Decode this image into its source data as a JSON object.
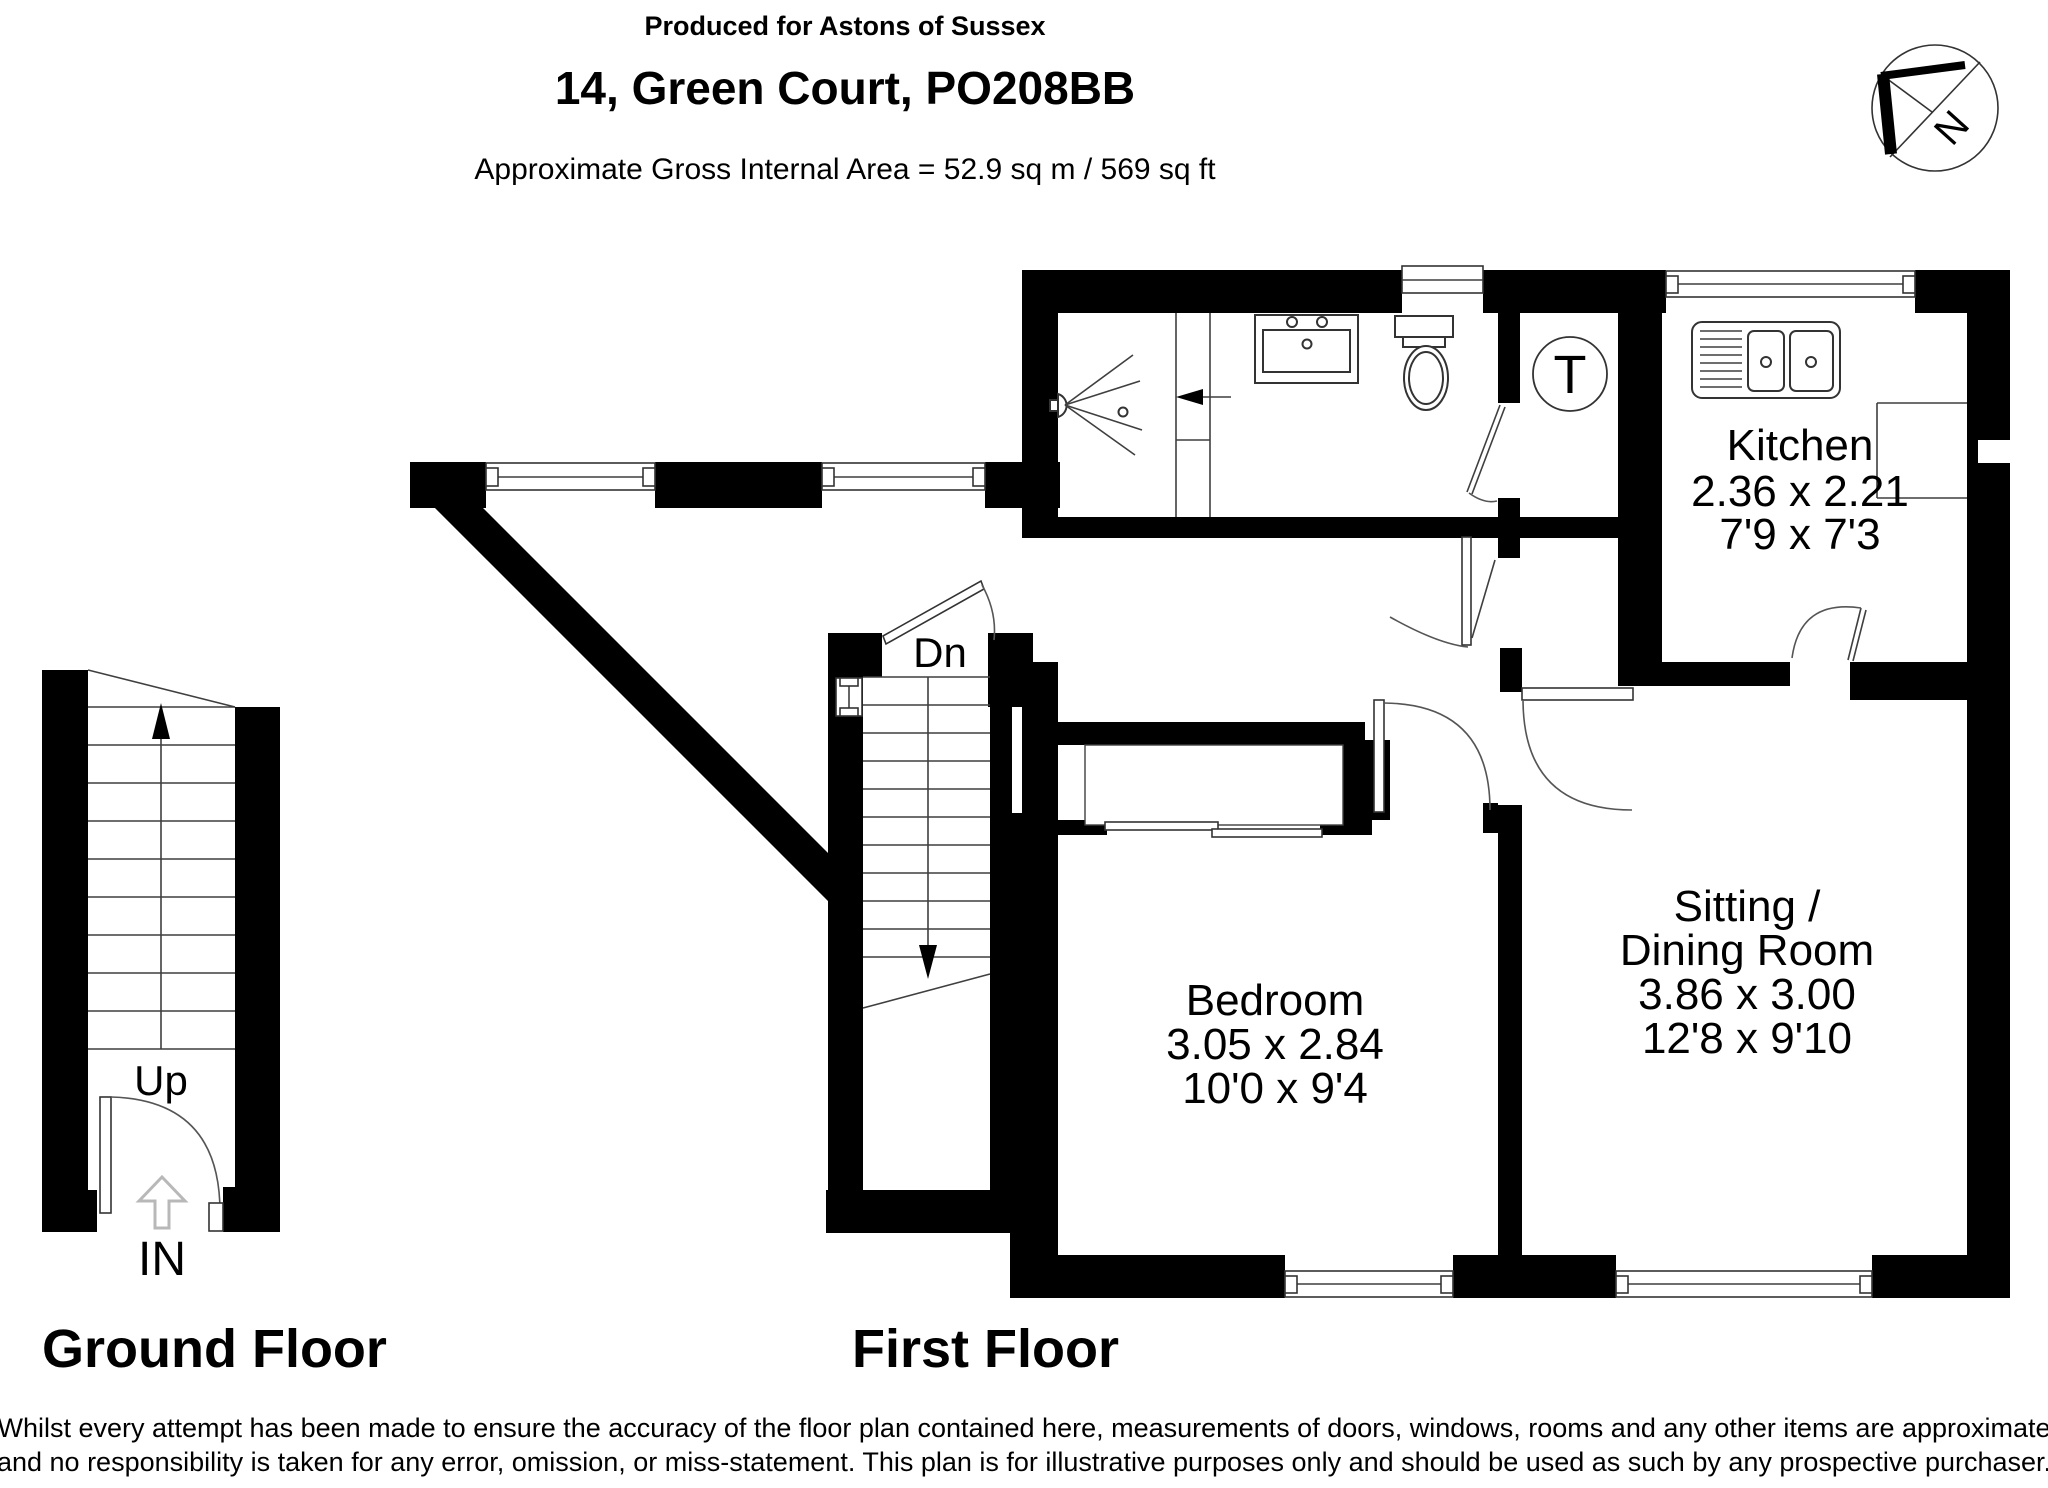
{
  "header": {
    "produced_for": "Produced for Astons of Sussex",
    "address": "14, Green Court, PO208BB",
    "area_line": "Approximate Gross Internal Area = 52.9 sq m / 569 sq ft"
  },
  "compass": {
    "north_label": "N"
  },
  "floors": {
    "ground": {
      "label": "Ground Floor",
      "up_label": "Up",
      "in_label": "IN"
    },
    "first": {
      "label": "First Floor",
      "down_label": "Dn",
      "tank_label": "T"
    }
  },
  "rooms": {
    "kitchen": {
      "name": "Kitchen",
      "metric": "2.36 x 2.21",
      "imperial": "7'9 x 7'3"
    },
    "bedroom": {
      "name": "Bedroom",
      "metric": "3.05 x 2.84",
      "imperial": "10'0 x 9'4"
    },
    "sitting": {
      "name_line1": "Sitting /",
      "name_line2": "Dining Room",
      "metric": "3.86 x 3.00",
      "imperial": "12'8 x 9'10"
    }
  },
  "disclaimer": {
    "line1": "Whilst every attempt has been made to ensure the accuracy of the floor plan contained here, measurements of doors, windows, rooms and any other items are approximate",
    "line2": "and no responsibility is taken for any error, omission, or miss-statement. This plan is for illustrative purposes only and should be used as such by any prospective purchaser."
  },
  "colors": {
    "wall": "#000000",
    "line": "#3f3f3f",
    "in_arrow": "#b8b8b8"
  }
}
